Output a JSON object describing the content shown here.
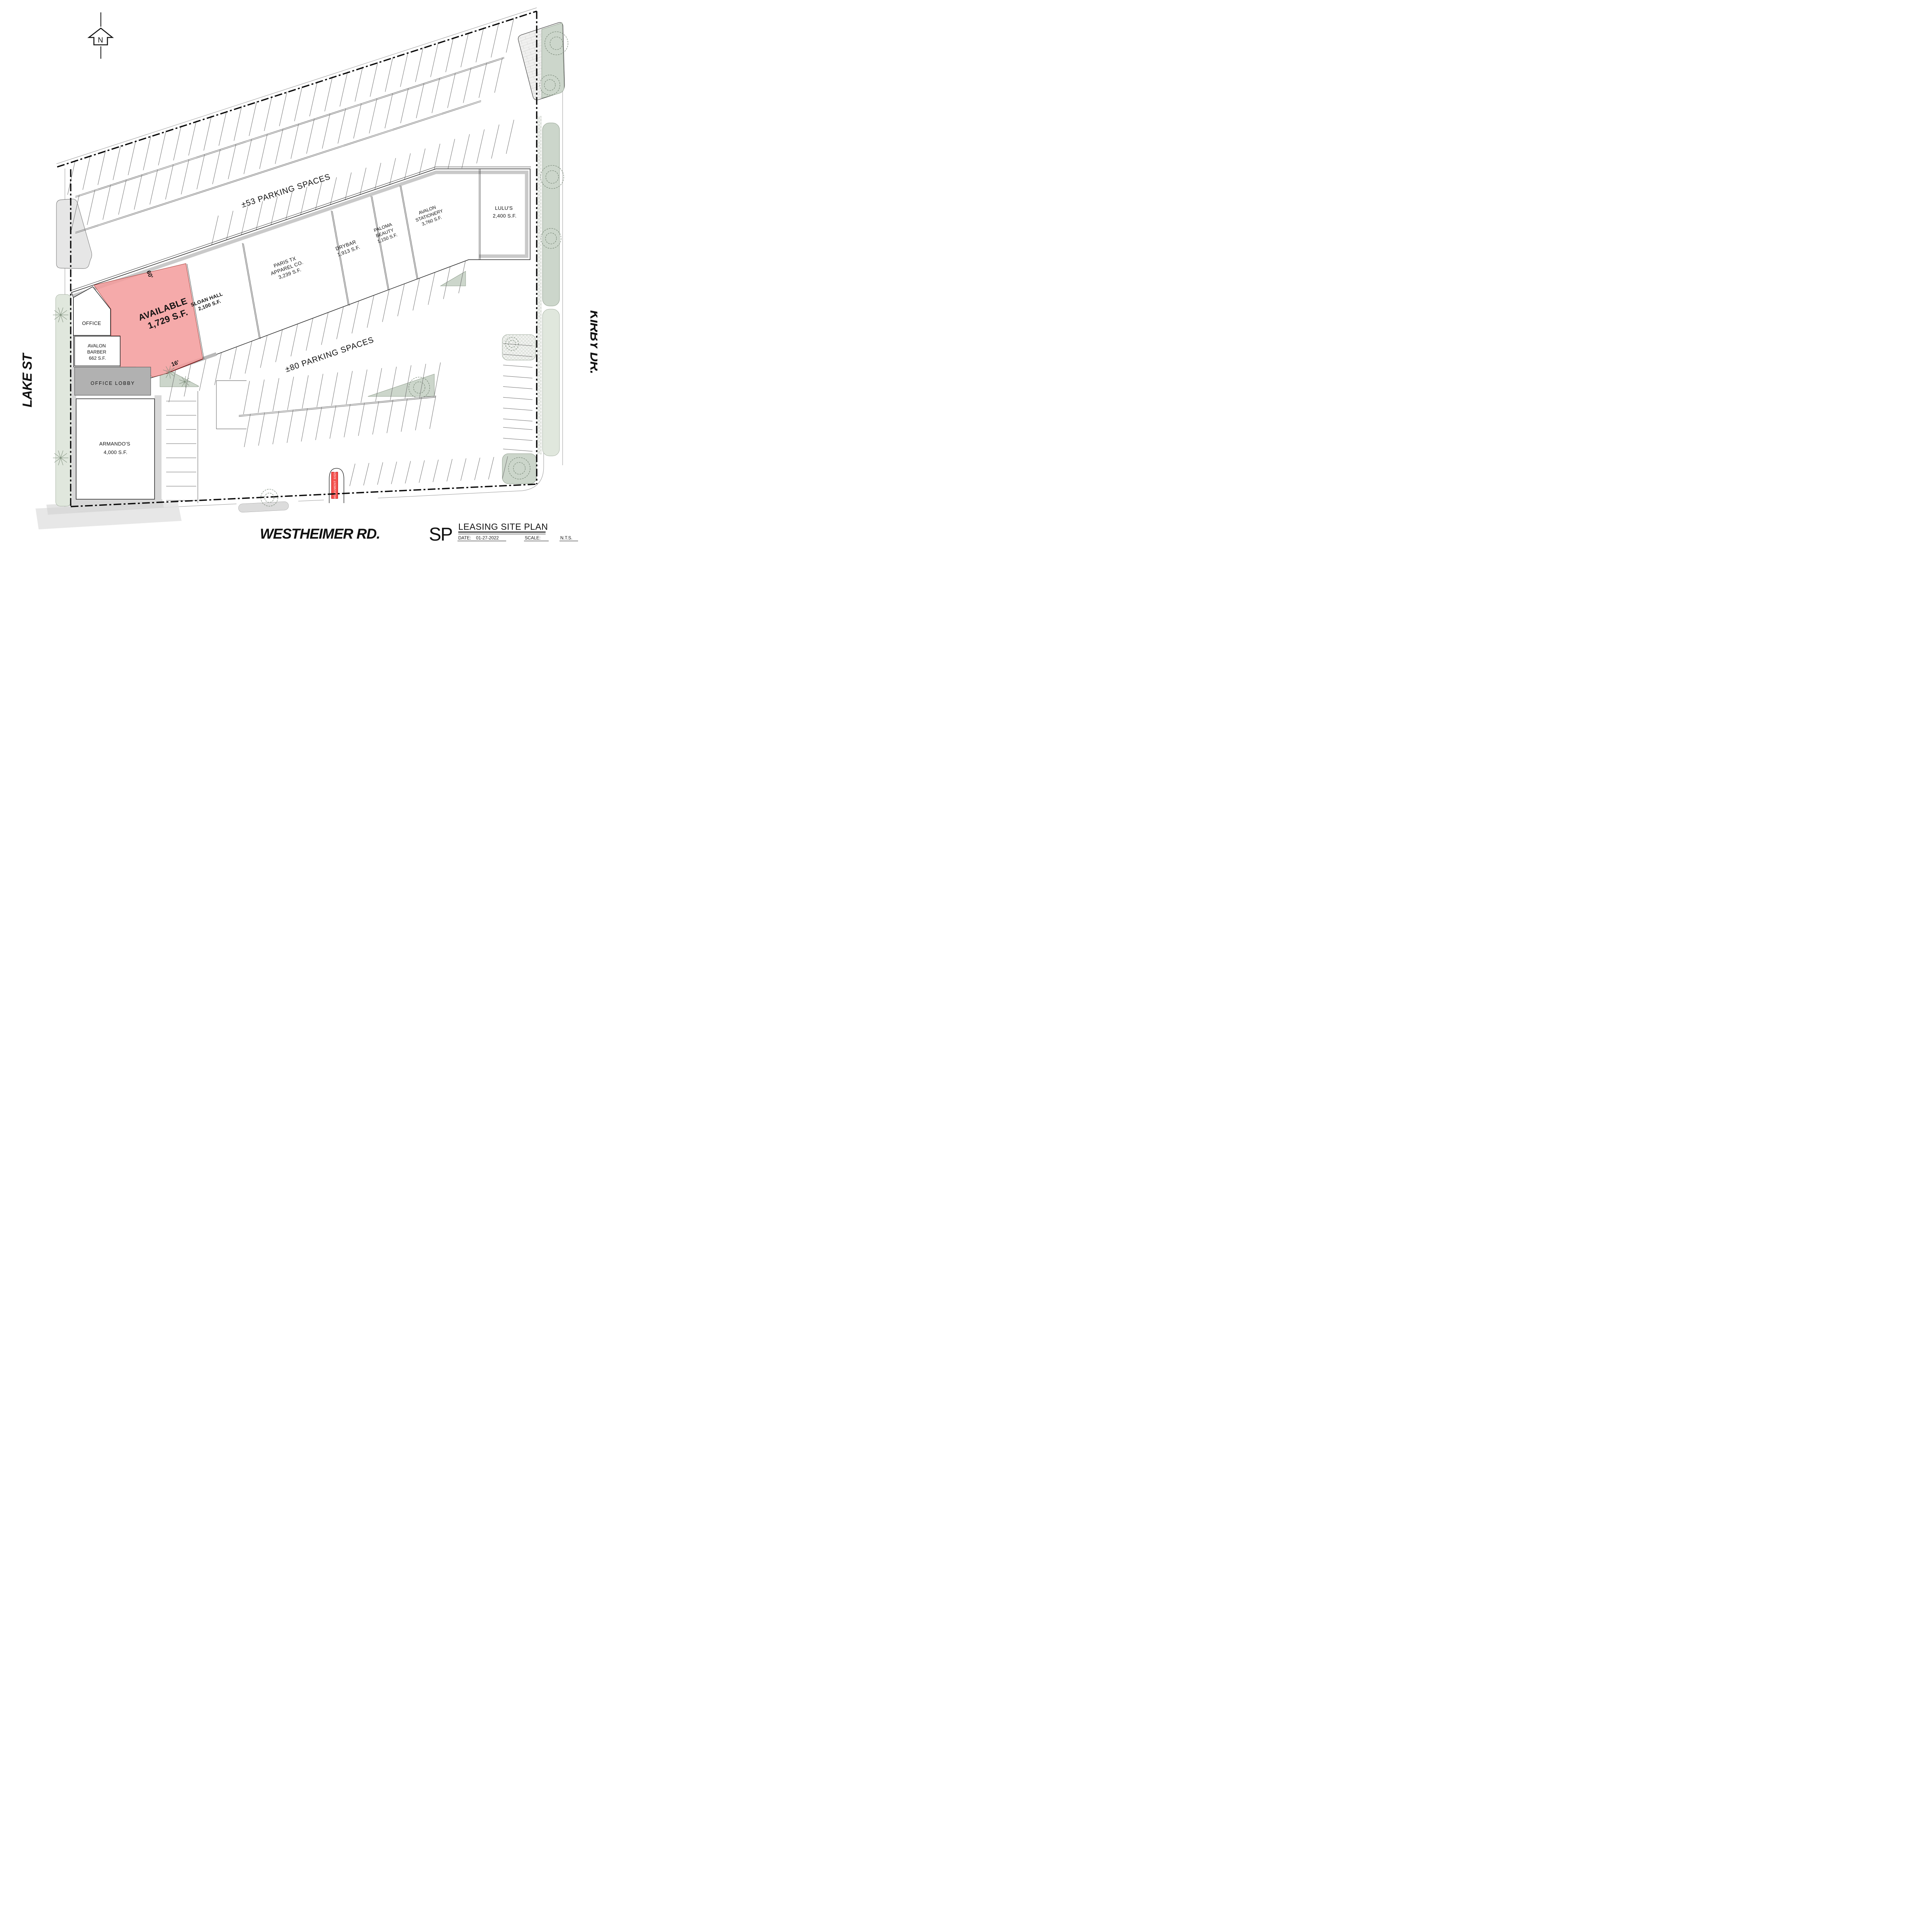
{
  "plan": {
    "north_label": "N",
    "streets": {
      "left": "LAKE ST",
      "right": "KIRBY DR.",
      "bottom": "WESTHEIMER RD."
    },
    "parking": {
      "top": "±53 PARKING SPACES",
      "middle": "±80 PARKING SPACES"
    },
    "dimensions": {
      "depth": "60'",
      "width": "16'"
    },
    "monument_sign": "MONUMENT SIGN",
    "colors": {
      "available_fill": "#f5a9a9",
      "monument_red": "#f4514e",
      "landscape_green": "#ccd6cb"
    },
    "units": [
      {
        "id": "office",
        "lines": [
          "OFFICE"
        ]
      },
      {
        "id": "avalon-barber",
        "lines": [
          "AVALON",
          "BARBER",
          "662 S.F."
        ]
      },
      {
        "id": "available",
        "lines": [
          "AVAILABLE",
          "1,729 S.F."
        ]
      },
      {
        "id": "sloan-hall",
        "lines": [
          "SLOAN HALL",
          "2,100 S.F."
        ]
      },
      {
        "id": "paris-tx-apparel",
        "lines": [
          "PARIS TX",
          "APPAREL CO.",
          "3,239 S.F."
        ]
      },
      {
        "id": "drybar",
        "lines": [
          "DRYBAR",
          "1,913 S.F."
        ]
      },
      {
        "id": "paloma-beauty",
        "lines": [
          "PALOMA",
          "BEAUTY",
          "1,150 S.F."
        ]
      },
      {
        "id": "avalon-stationery",
        "lines": [
          "AVALON",
          "STATIONERY",
          "3,760 S.F."
        ]
      },
      {
        "id": "lulus",
        "lines": [
          "LULU'S",
          "2,400 S.F."
        ]
      },
      {
        "id": "office-lobby",
        "lines": [
          "OFFICE LOBBY"
        ]
      },
      {
        "id": "armandos",
        "lines": [
          "ARMANDO'S",
          "4,000 S.F."
        ]
      }
    ],
    "title_block": {
      "code": "SP",
      "title": "LEASING SITE PLAN",
      "date_label": "DATE:",
      "date": "01-27-2022",
      "scale_label": "SCALE:",
      "scale": "N.T.S."
    }
  }
}
